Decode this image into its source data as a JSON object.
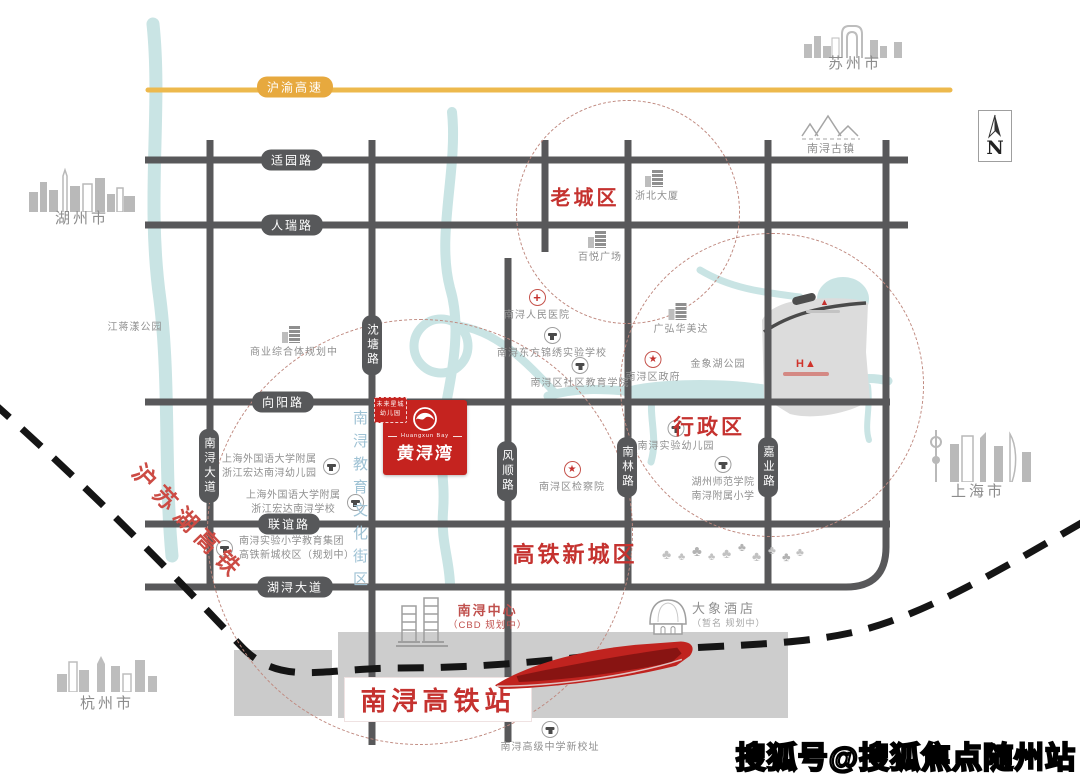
{
  "watermark": "搜狐号@搜狐焦点随州站",
  "compass_n": "N",
  "highway": "沪渝高速",
  "hsr": "沪苏湖高铁",
  "east_logo": "H▲",
  "edu_strip": "南浔教育文化街区",
  "cities": {
    "huzhou": "湖州市",
    "suzhou": "苏州市",
    "shanghai": "上海市",
    "hangzhou": "杭州市"
  },
  "roads": {
    "h1": "适园路",
    "h2": "人瑞路",
    "h3": "向阳路",
    "h4": "联谊路",
    "h5": "湖浔大道",
    "v1": "沈塘路",
    "v2": "南浔大道",
    "v3": "风顺路",
    "v4": "南林路",
    "v5": "嘉业路"
  },
  "districts": {
    "old_town": "老城区",
    "admin": "行政区",
    "new_town": "高铁新城区"
  },
  "station": "南浔高铁站",
  "project": {
    "kg1": "未来星城",
    "kg2": "幼儿园",
    "en": "Huangxun Bay",
    "cn": "黄浔湾"
  },
  "landmarks": [
    {
      "label": "浙北大厦"
    },
    {
      "label": "百悦广场"
    },
    {
      "label": "商业综合体规划中"
    },
    {
      "label": "南浔人民医院"
    },
    {
      "label": "南浔东方锦绣实验学校"
    },
    {
      "label": "南浔区社区教育学院"
    },
    {
      "label": "广弘华美达"
    },
    {
      "label": "金象湖公园"
    },
    {
      "label": "南浔区政府"
    },
    {
      "label": "南浔实验幼儿园"
    },
    {
      "label": "湖州师范学院",
      "label2": "南浔附属小学"
    },
    {
      "label": "南浔区检察院"
    },
    {
      "label": "上海外国语大学附属",
      "label2": "浙江宏达南浔幼儿园"
    },
    {
      "label": "上海外国语大学附属",
      "label2": "浙江宏达南浔学校"
    },
    {
      "label": "南浔实验小学教育集团",
      "label2": "高铁新城校区（规划中）"
    },
    {
      "label": "南浔中心",
      "label2": "（CBD 规划中）"
    },
    {
      "label": "大象酒店",
      "label2": "（暂名 规划中）"
    },
    {
      "label": "南浔高级中学新校址"
    },
    {
      "label": "南浔古镇"
    },
    {
      "label": "江蒋漾公园"
    }
  ],
  "colors": {
    "road": "#58585A",
    "highway": "#EDB94D",
    "river": "#C9E4E4",
    "accent_red": "#C5322F",
    "rail": "#151515",
    "brand_red": "#C5231F",
    "ring_dash": "#C08A80"
  }
}
